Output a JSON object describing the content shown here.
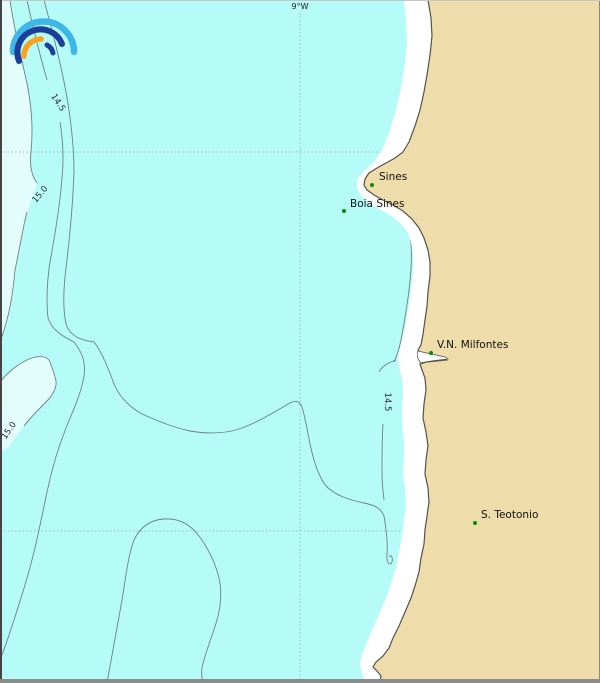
{
  "map": {
    "meridian_label": "9°W",
    "places": [
      {
        "name": "Sines"
      },
      {
        "name": "Boia Sines"
      },
      {
        "name": "V.N. Milfontes"
      },
      {
        "name": "S. Teotonio"
      }
    ],
    "contour_labels": [
      {
        "text": "14.5"
      },
      {
        "text": "15.0"
      },
      {
        "text": "15.0"
      },
      {
        "text": "14.5"
      }
    ],
    "colors": {
      "ocean": "#b5fbf8",
      "pale_water": "#e2fdfb",
      "land": "#eedcaa",
      "coast_outline": "#54544c",
      "contour_line": "#6f8080",
      "grid": "#9aa5a5",
      "marker_green": "#009000",
      "logo_light_blue": "#3eb7e8",
      "logo_dark_blue": "#1c3f99",
      "logo_orange": "#f9a21a"
    }
  }
}
